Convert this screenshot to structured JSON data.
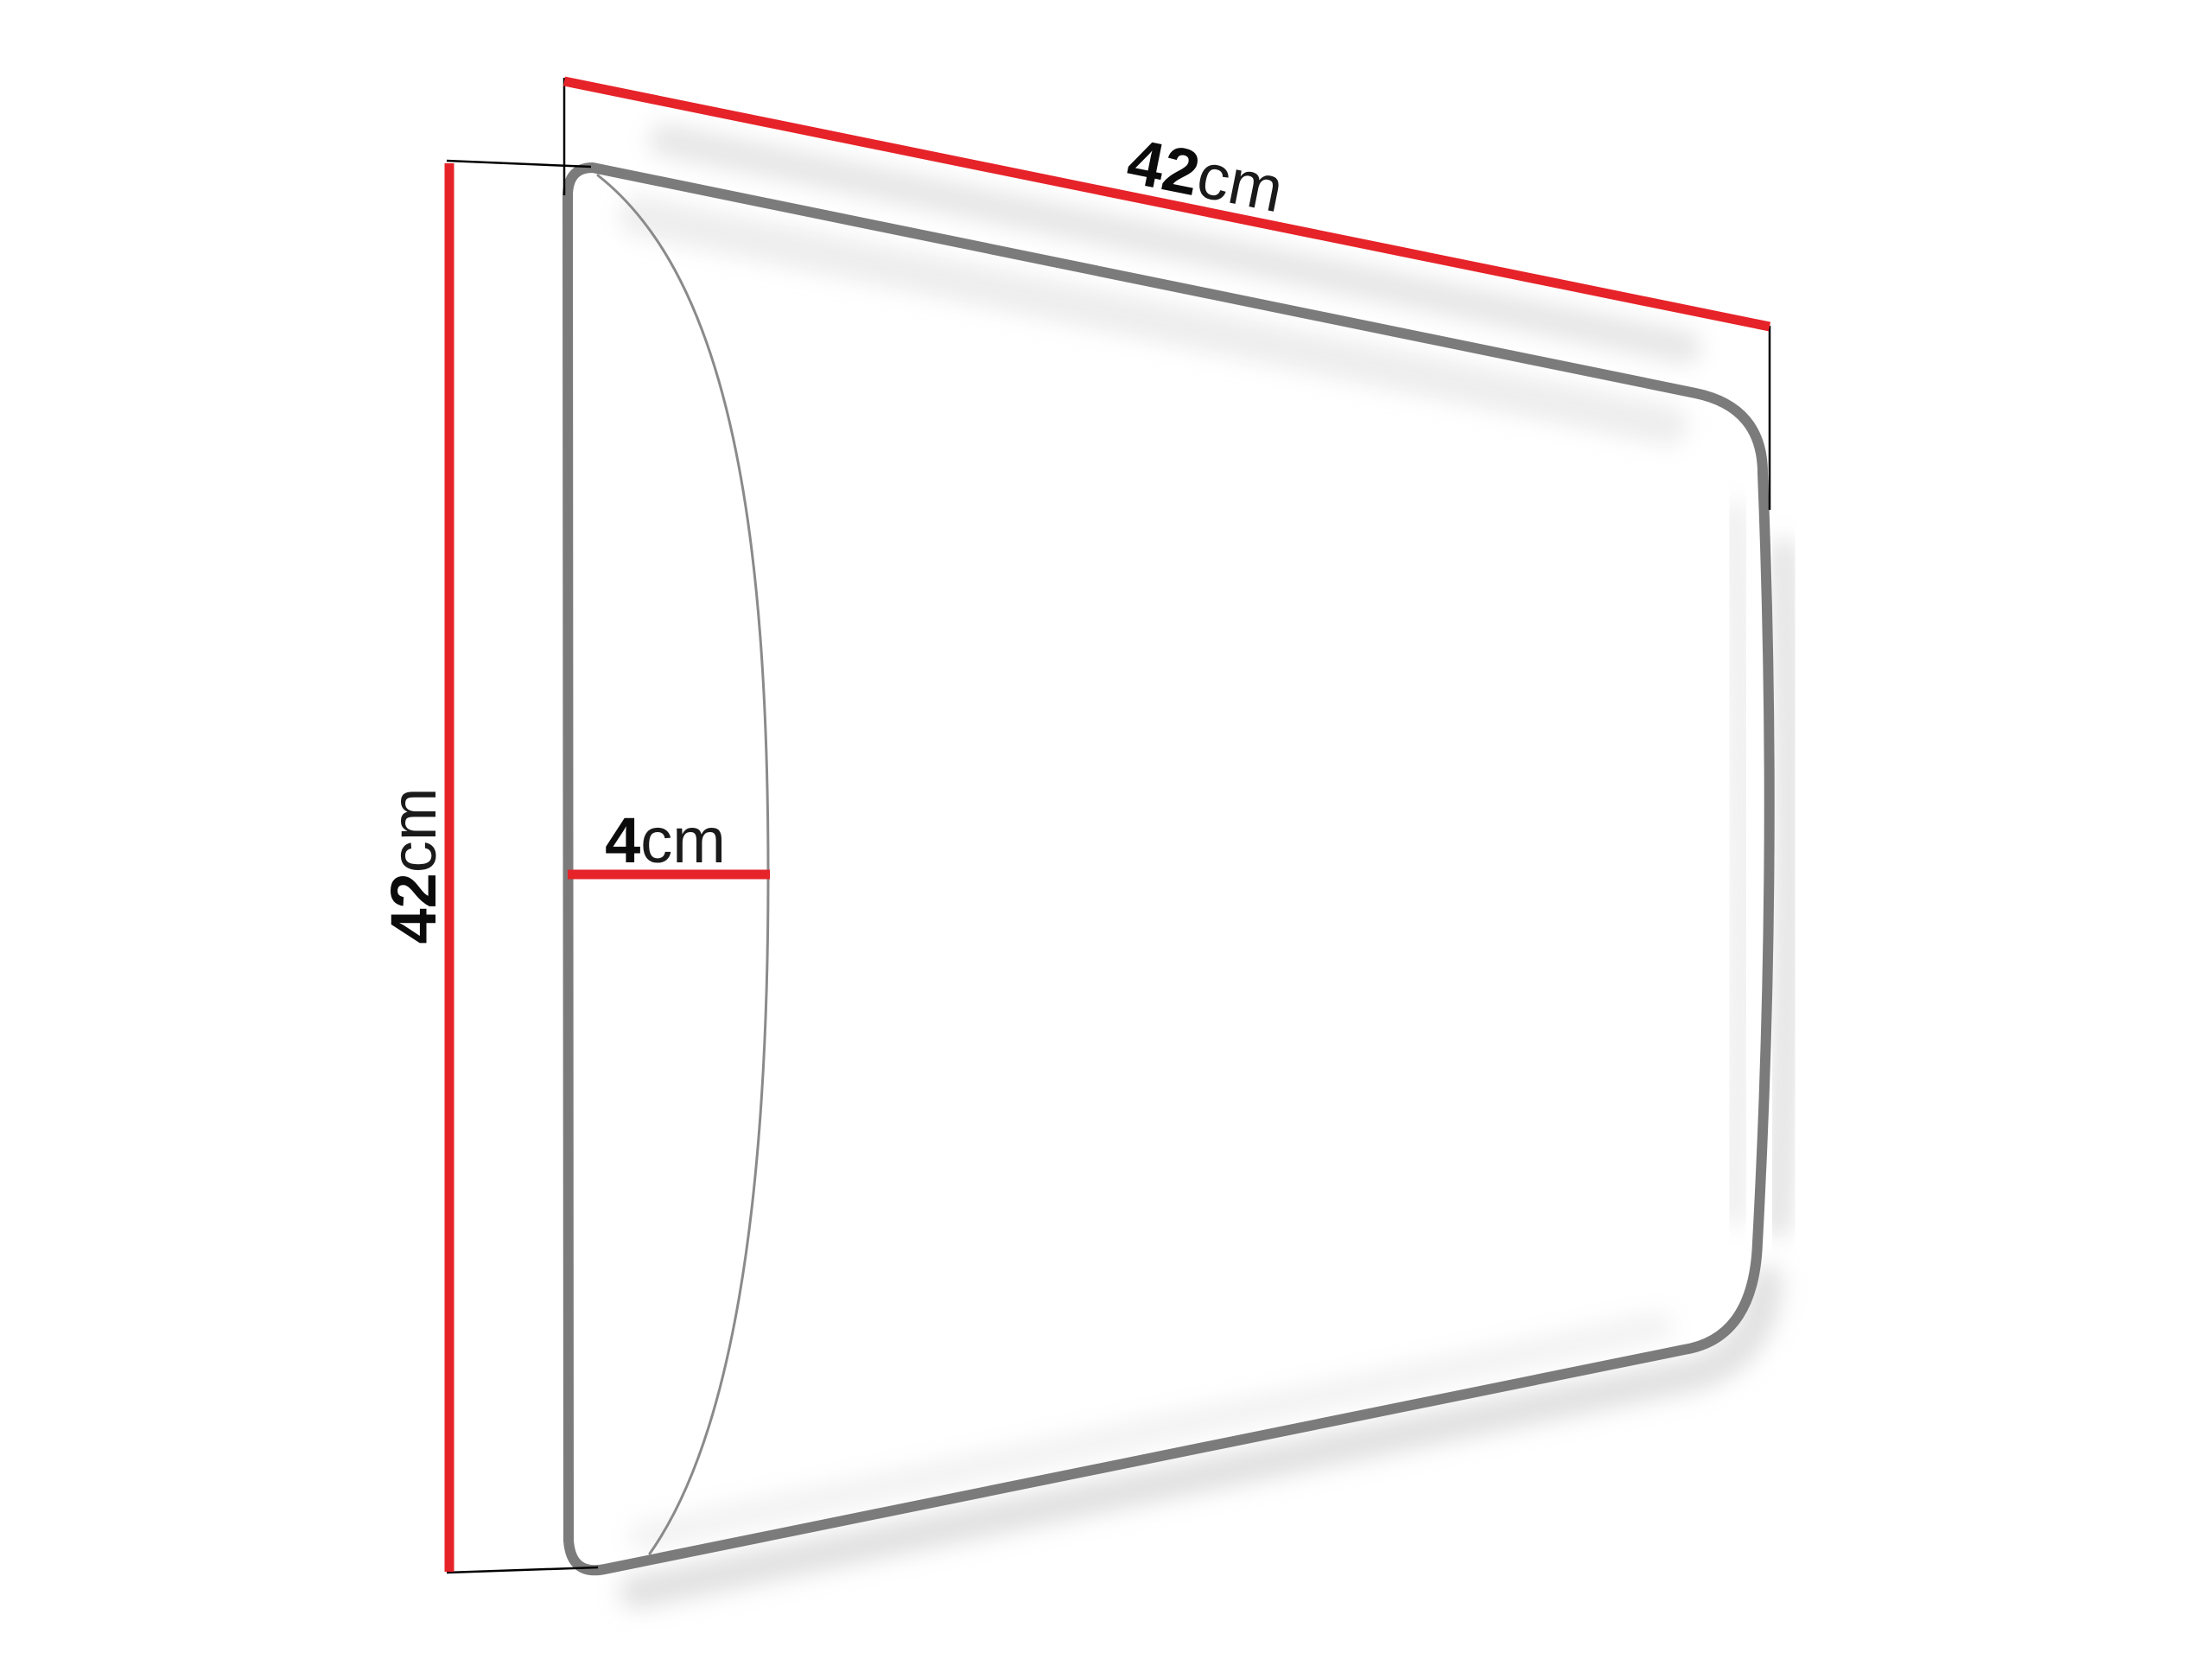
{
  "diagram": {
    "title": "upholstered-wall-panel-dimension-drawing",
    "dimensions": {
      "width": {
        "value": "42",
        "unit": "cm"
      },
      "height": {
        "value": "42",
        "unit": "cm"
      },
      "depth": {
        "value": "4",
        "unit": "cm"
      }
    },
    "colors": {
      "dimension_line": "#e62329",
      "panel_outline": "#7b7b7b",
      "bulge_curve": "#8a8a8a",
      "extension_line": "#000000",
      "shadow": "#c9c9c9",
      "background": "#ffffff",
      "label_text": "#0e0e0e"
    }
  }
}
